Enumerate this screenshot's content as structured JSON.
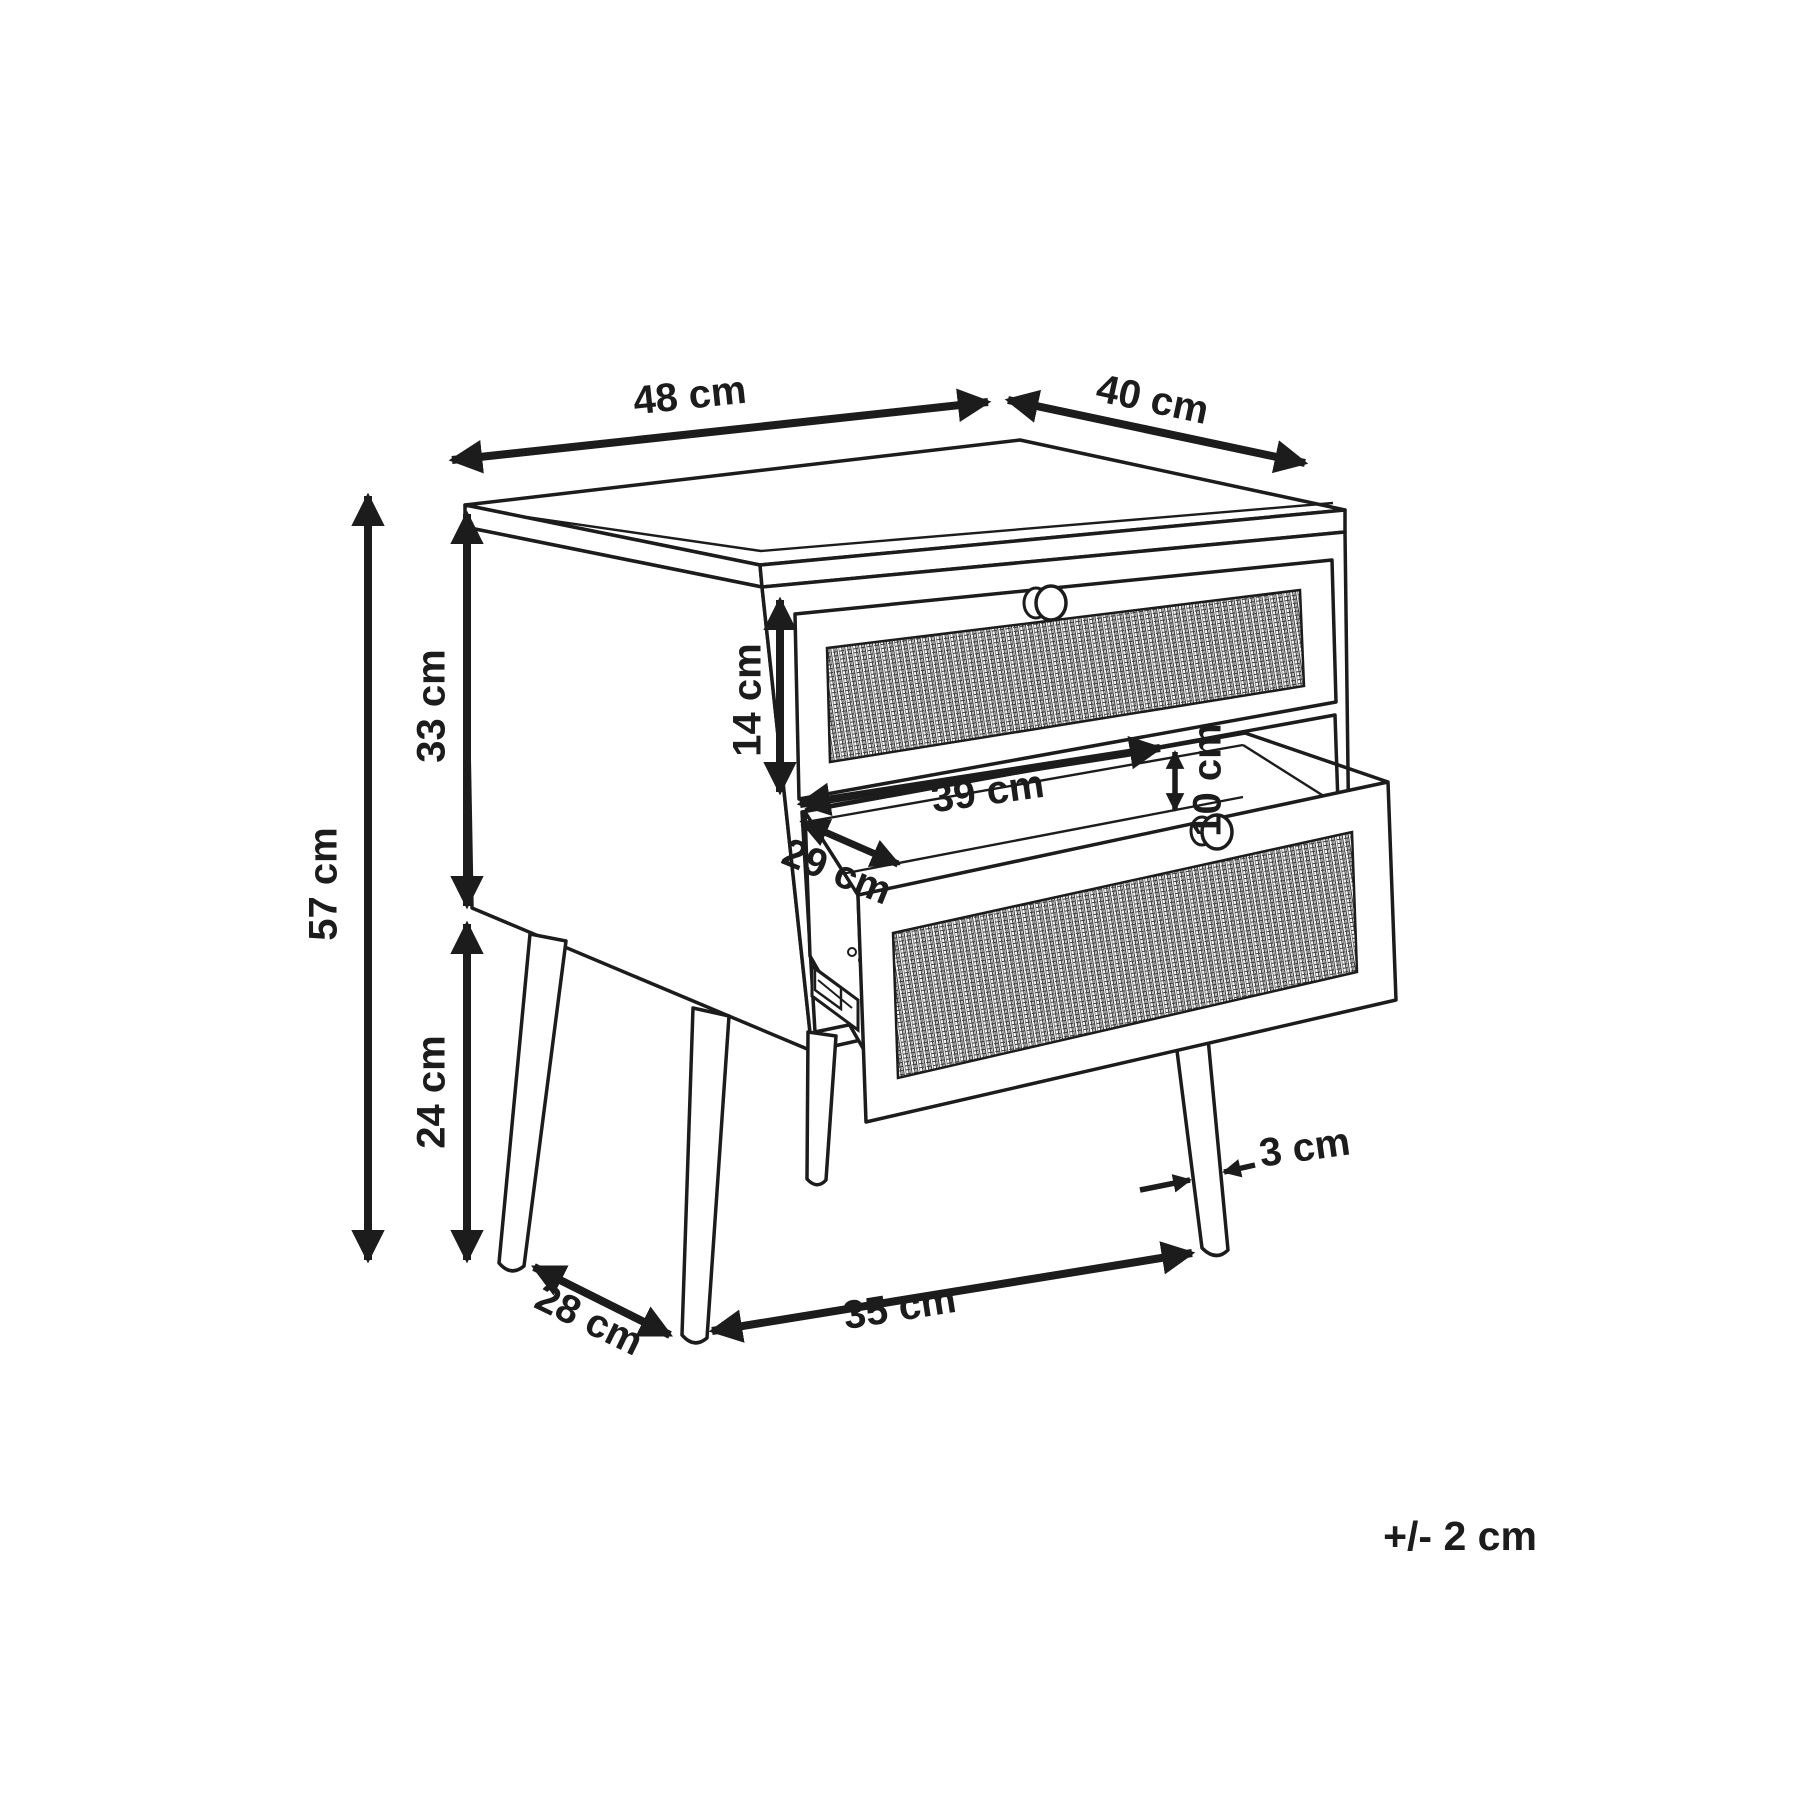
{
  "diagram": {
    "object": "bedside table with two rattan-front drawers and four round tapered legs, lower drawer pulled open",
    "style": "black-and-white technical dimension drawing",
    "background_color": "#ffffff",
    "line_color": "#1c1c1c",
    "drawer_count": 2,
    "leg_count": 4
  },
  "labels": {
    "top_width": "48 cm",
    "top_depth": "40 cm",
    "overall_height": "57 cm",
    "body_height": "33 cm",
    "leg_height": "24 cm",
    "drawer_front_height": "14 cm",
    "drawer_inner_width": "39 cm",
    "drawer_inner_depth": "29 cm",
    "drawer_inner_height": "10 cm",
    "leg_diameter": "3 cm",
    "leg_gap_side": "28 cm",
    "leg_gap_front": "35 cm",
    "tolerance": "+/- 2 cm"
  }
}
